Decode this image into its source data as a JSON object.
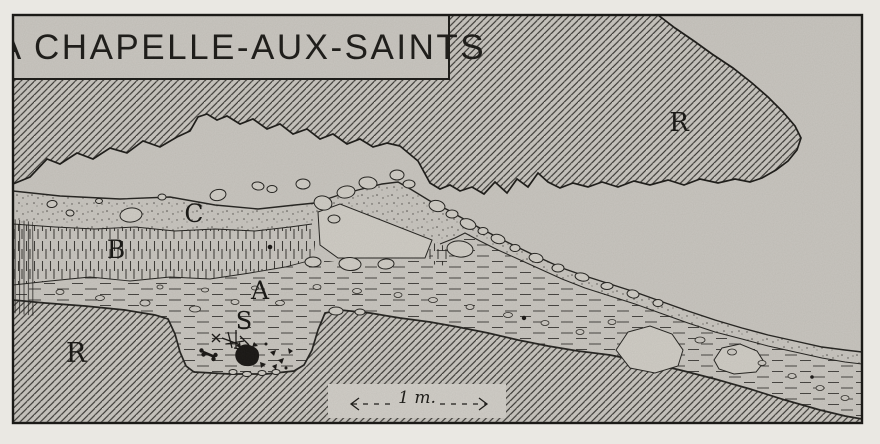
{
  "figure": {
    "title": "LA CHAPELLE-AUX-SAINTS"
  },
  "region_labels": {
    "upper_rock": "R",
    "layer_c": "C",
    "layer_b": "B",
    "layer_a": "A",
    "burial": "S",
    "lower_rock": "R"
  },
  "scale_bar": {
    "label": "1 m."
  },
  "colors": {
    "paper_margin": "#eae8e3",
    "ground": "#c8c5bf",
    "ink": "#1b1a17",
    "stone_fill": "#cfccc5"
  }
}
